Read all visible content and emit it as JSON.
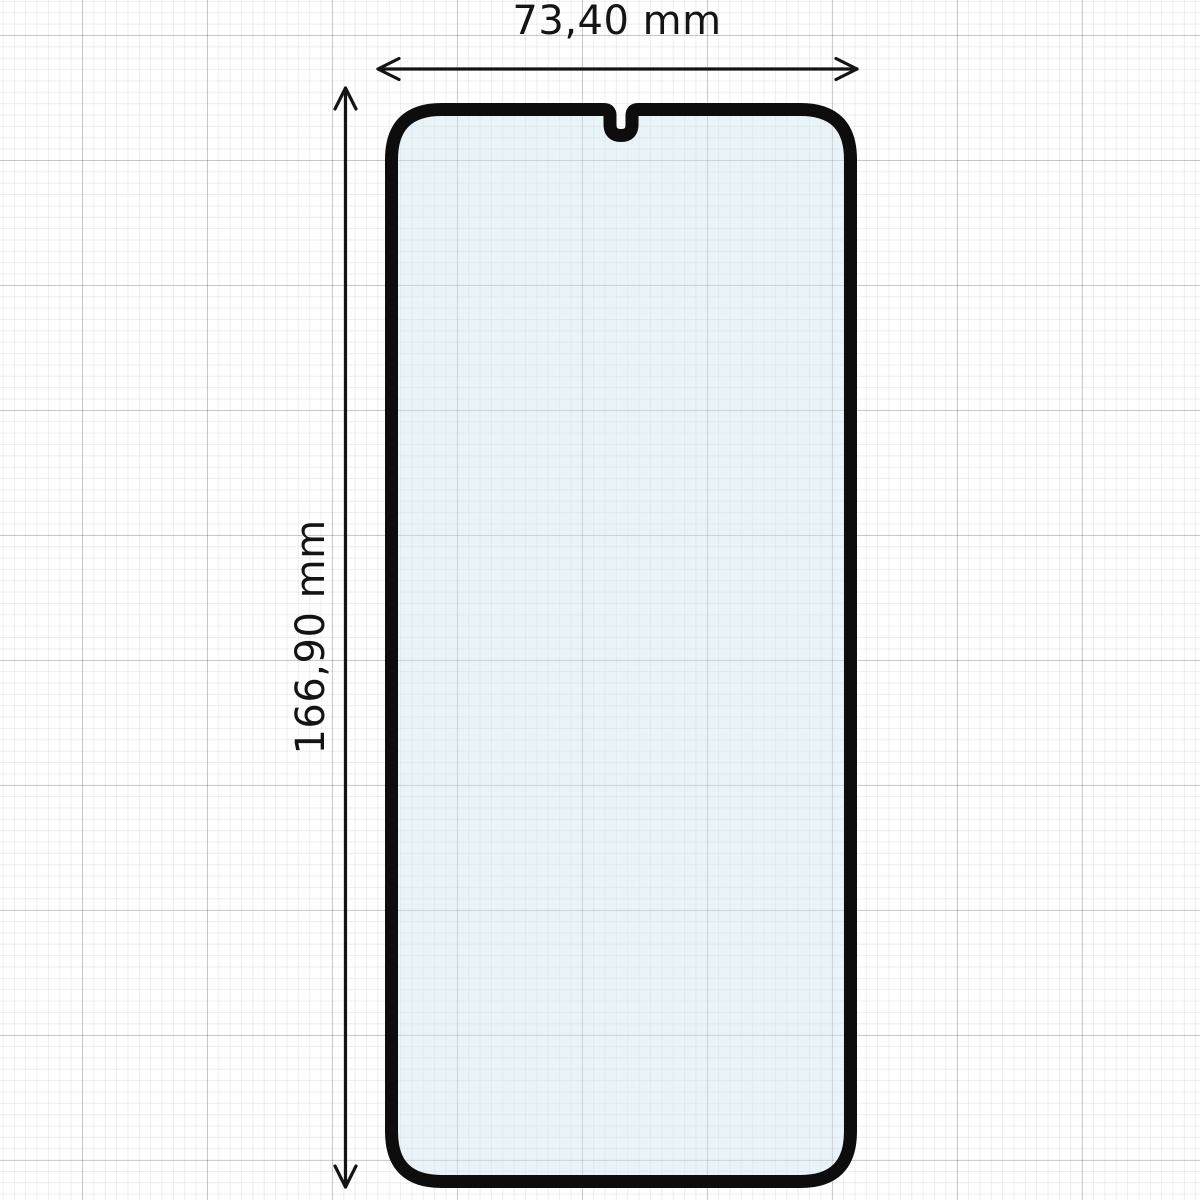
{
  "diagram": {
    "subject": "phone-screen-protector-dimension-diagram",
    "width_label": "73,40 mm",
    "height_label": "166,90 mm",
    "colors": {
      "outline": "#0d0d0d",
      "glass_fill": "#cfe5f0",
      "glass_fill_opacity": "0.45",
      "arrow": "#141414",
      "text": "#141414",
      "grid_minor": "#ededed",
      "grid_major": "#d4d4d4",
      "canvas": "#ffffff"
    }
  }
}
